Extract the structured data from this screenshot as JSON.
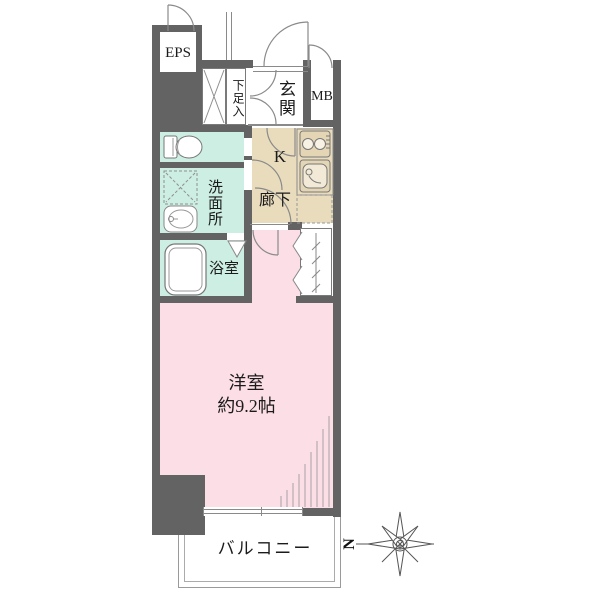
{
  "plan": {
    "title": "apartment-floor-plan",
    "labels": {
      "eps": "EPS",
      "shoe_storage": "下足入",
      "entrance": "玄関",
      "meter_box": "MB",
      "kitchen": "K",
      "hallway": "廊下",
      "washroom": "洗面所",
      "bathroom": "浴室",
      "main_room": "洋室",
      "main_room_size": "約9.2帖",
      "balcony": "バルコニー",
      "north": "N"
    },
    "colors": {
      "wall": "#636363",
      "wet_room": "#cdeee2",
      "hallway_kitchen": "#e9dcbd",
      "main_room": "#fbdee6",
      "line": "#8a8a8a"
    }
  }
}
